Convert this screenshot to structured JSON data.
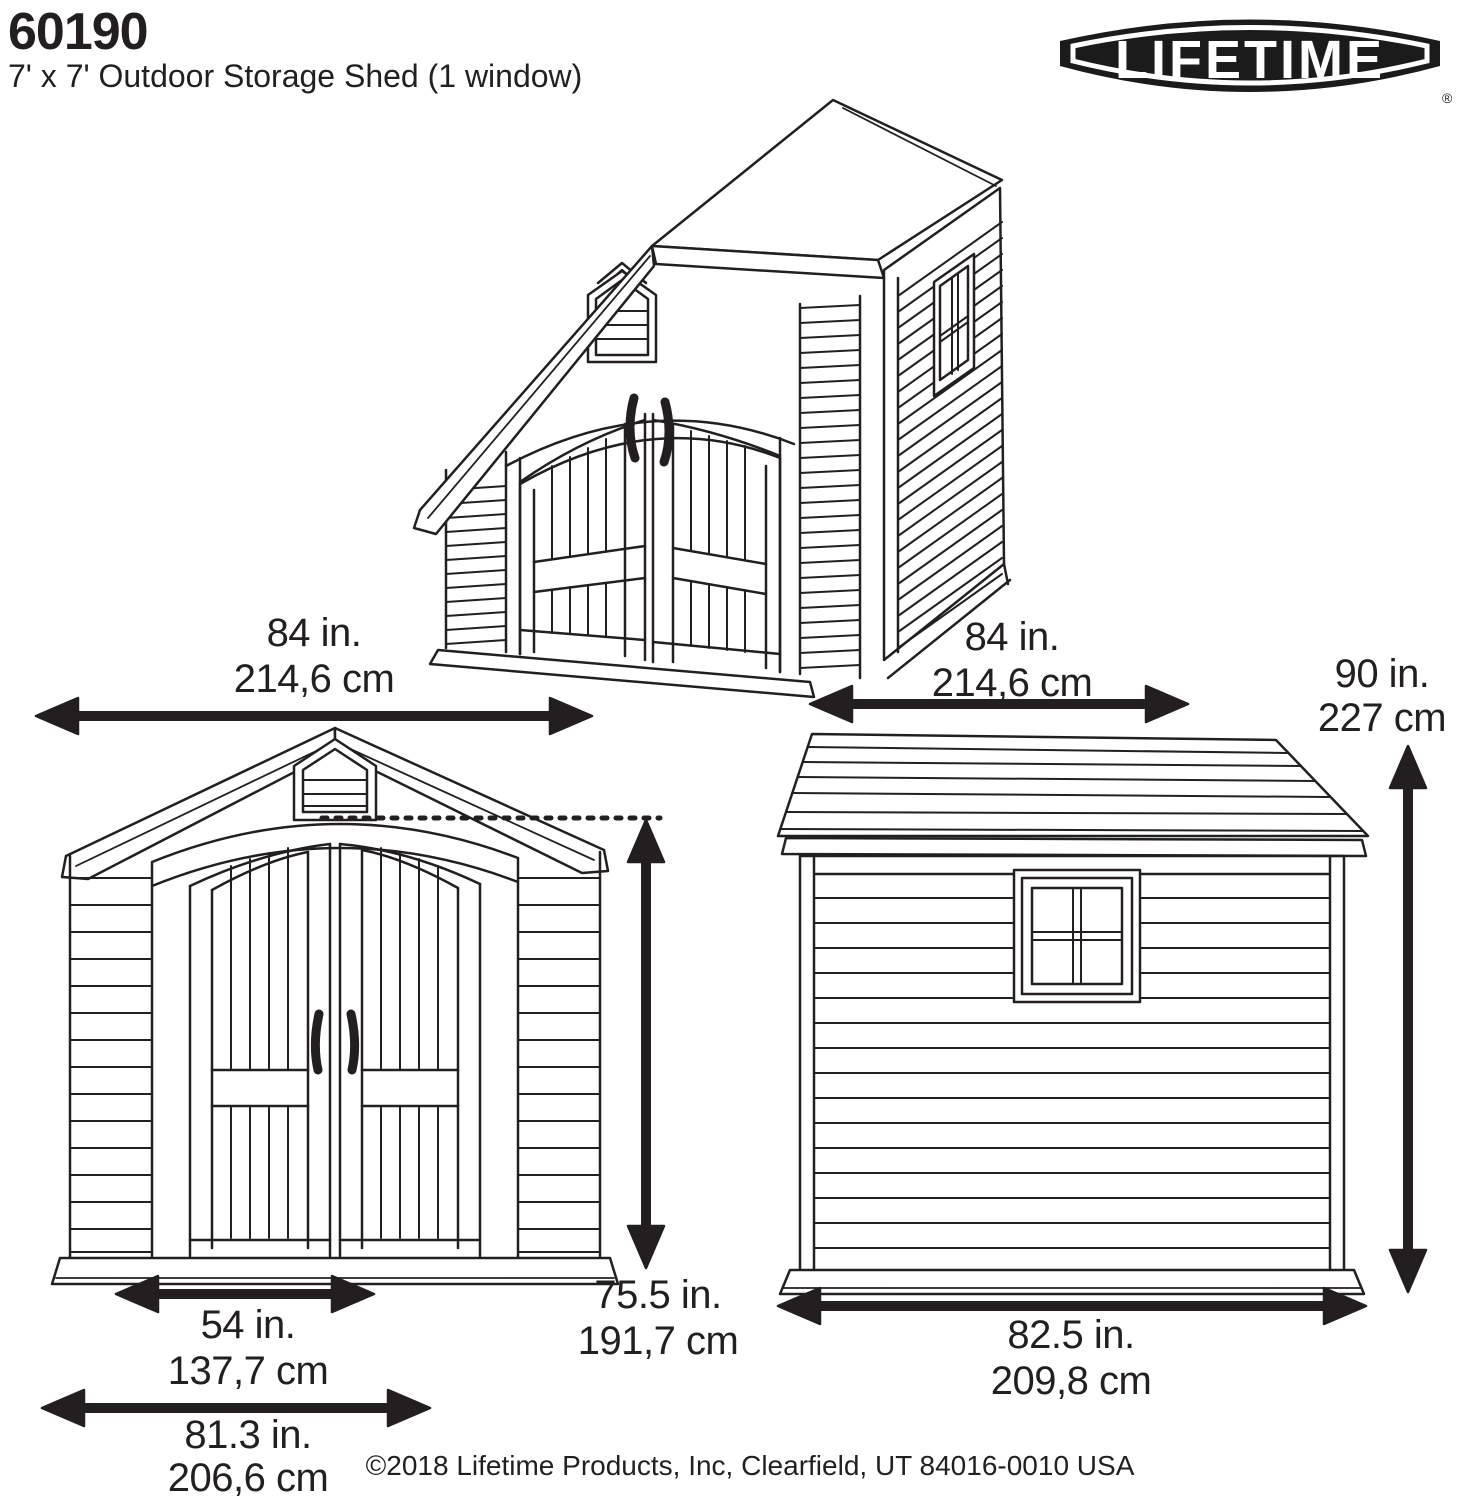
{
  "header": {
    "model_number": "60190",
    "subtitle": "7' x 7' Outdoor Storage Shed (1 window)"
  },
  "logo": {
    "brand": "LIFETIME",
    "registered_mark": "®"
  },
  "dimensions": {
    "front_width": {
      "inches": "84 in.",
      "metric": "214,6 cm"
    },
    "depth": {
      "inches": "84 in.",
      "metric": "214,6 cm"
    },
    "height": {
      "inches": "90 in.",
      "metric": "227 cm"
    },
    "door_height": {
      "inches": "75.5 in.",
      "metric": "191,7 cm"
    },
    "door_width": {
      "inches": "54 in.",
      "metric": "137,7 cm"
    },
    "base_width": {
      "inches": "81.3 in.",
      "metric": "206,6 cm"
    },
    "base_depth": {
      "inches": "82.5 in.",
      "metric": "209,8 cm"
    }
  },
  "footer": {
    "copyright": "©2018 Lifetime Products, Inc, Clearfield, UT 84016-0010 USA"
  },
  "colors": {
    "line": "#231f20",
    "background": "#ffffff"
  }
}
